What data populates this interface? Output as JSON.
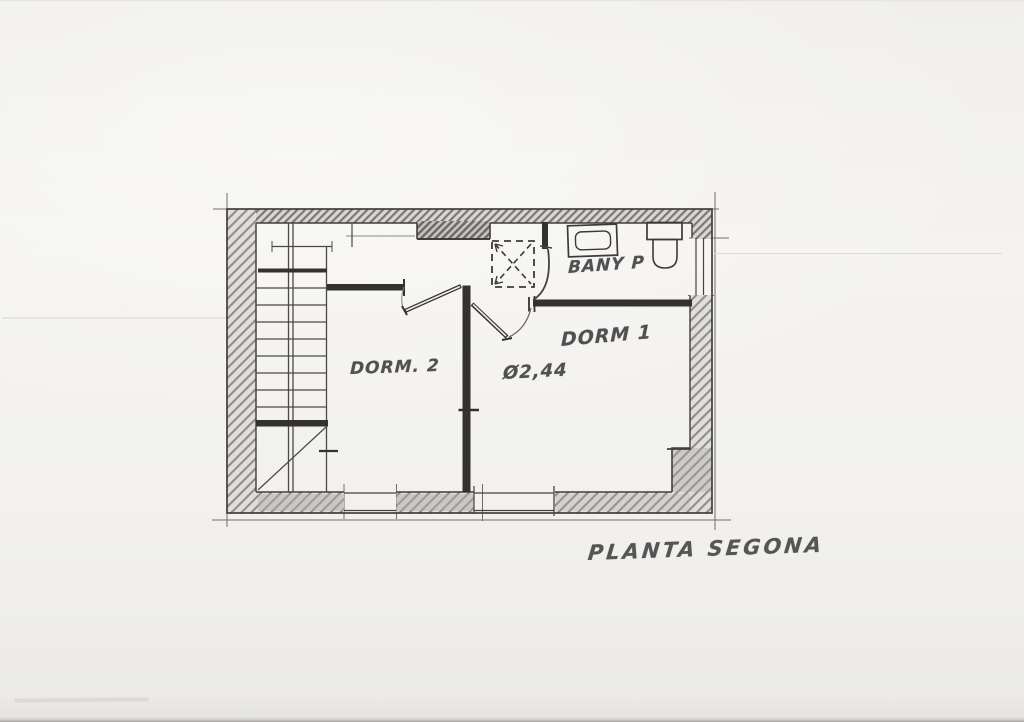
{
  "drawing": {
    "title": "PLANTA SEGONA",
    "labels": {
      "dorm1": "DORM 1",
      "dorm2": "DORM. 2",
      "bany": "BANY P",
      "dimension": "Ø2,44"
    },
    "colors": {
      "paper": "#f2f1ee",
      "pencil_dark": "#34322f",
      "pencil_mid": "#43413e",
      "hatch": "#8b8986"
    }
  }
}
